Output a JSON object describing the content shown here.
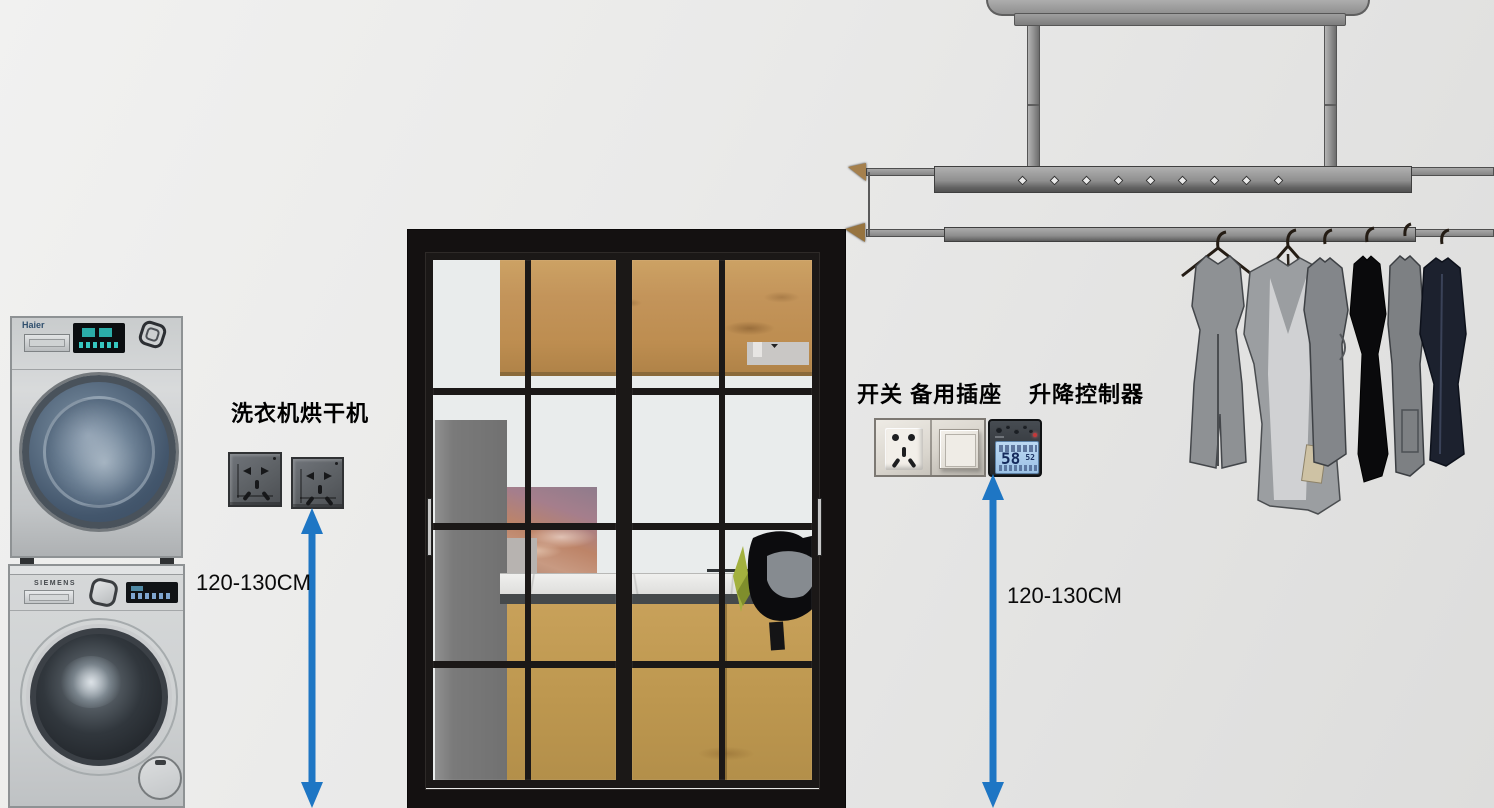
{
  "scene": {
    "width": 1494,
    "height": 808,
    "background": "#eaeae9"
  },
  "left_station": {
    "washer": {
      "brand": "Haier"
    },
    "dryer": {
      "brand": "SIEMENS"
    },
    "label": "洗衣机烘干机",
    "outlets": [
      {
        "type": "5-hole-socket",
        "color": "#5d6165"
      },
      {
        "type": "5-hole-socket",
        "color": "#5d6165"
      }
    ],
    "measurement": {
      "text": "120-130CM"
    }
  },
  "right_station": {
    "labels": {
      "switch_and_socket": "开关 备用插座",
      "lift_controller": "升降控制器"
    },
    "wall_plate": {
      "socket": "5-hole-socket",
      "switch": "rocker-switch"
    },
    "controller": {
      "lcd_main": "58",
      "lcd_sub": "52",
      "indicator": "red-led"
    },
    "measurement": {
      "text": "120-130CM"
    }
  },
  "door": {
    "type": "black-framed-glass-sliding-door",
    "panels": 2,
    "pane_columns": 4,
    "pane_rows": 4,
    "behind_glass": [
      "wood-wall-cabinet",
      "range-hood",
      "gray-column",
      "sunset-window",
      "marble-countertop",
      "wood-base-cabinet",
      "black-chair-with-plant"
    ]
  },
  "drying_rack": {
    "type": "ceiling-mounted-lift-drying-rack",
    "clothes_count": 6,
    "clothes_colors": [
      "#8e9194",
      "#9b9ea1",
      "#83868a",
      "#0a0a0c",
      "#7d8083",
      "#1c212e"
    ]
  },
  "colors": {
    "arrow": "#1e76c4",
    "lcd_screen": "#a9cbec",
    "door_frame": "#141111",
    "wood": "#c2914f",
    "outlet_dark": "#5d6165",
    "background": "#eaeae9"
  }
}
